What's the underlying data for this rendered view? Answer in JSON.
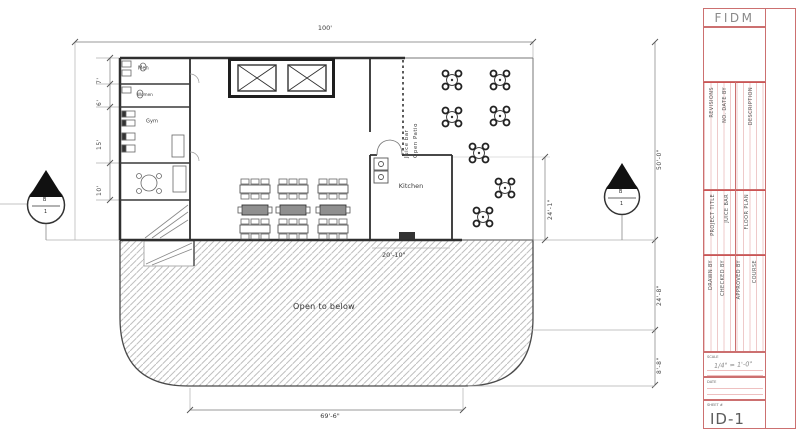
{
  "plan": {
    "labels": {
      "men": "Men",
      "women": "Women",
      "gym": "Gym",
      "kitchen": "Kitchen",
      "juice_bar": "Juice bar",
      "open_patio": "Open Patio",
      "open_to_below": "Open to below"
    },
    "dimensions": {
      "top_width": "100'",
      "bottom_width": "69'-6\"",
      "left_chain": [
        "7'",
        "6'",
        "15'",
        "10'"
      ],
      "right_chain": [
        "50'-0\"",
        "24'-8\"",
        "8'-8\""
      ],
      "kitchen_width": "20'-10\"",
      "patio_depth": "24'-1\""
    },
    "section_markers": {
      "left": {
        "letter": "B",
        "number": "1"
      },
      "right": {
        "letter": "B",
        "number": "1"
      }
    }
  },
  "title_block": {
    "logo": "FIDM",
    "info_sections": [
      {
        "lines": [
          "REVISIONS",
          "NO. DATE BY",
          "DESCRIPTION"
        ]
      },
      {
        "lines": [
          "PROJECT TITLE",
          "JUICE BAR",
          "FLOOR PLAN"
        ]
      },
      {
        "lines": [
          "DRAWN BY",
          "CHECKED BY",
          "APPROVED BY",
          "COURSE"
        ]
      }
    ],
    "scale": {
      "label": "SCALE",
      "value": "1/4\" = 1'-0\""
    },
    "date": {
      "label": "DATE"
    },
    "sheet": {
      "label": "SHEET #",
      "number": "ID-1"
    }
  },
  "colors": {
    "rule_red": "#cc7070",
    "wall_dark": "#2f2f2f",
    "hatch_gray": "#bfbfbf"
  }
}
